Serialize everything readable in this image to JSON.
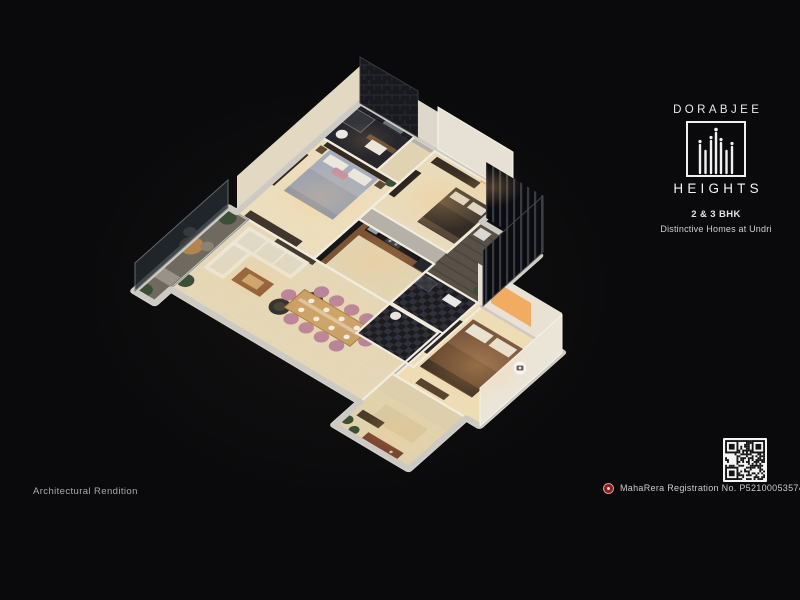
{
  "page": {
    "background": "#0a0a0c",
    "width": 800,
    "height": 600
  },
  "brand": {
    "name_line1": "DORABJEE",
    "name_line2": "HEIGHTS",
    "offering": "2 & 3 BHK",
    "tagline": "Distinctive Homes at Undri"
  },
  "footer": {
    "rendition_note": "Architectural Rendition",
    "rera_label": "MahaRera Registration No. P52100053574"
  },
  "floorplan": {
    "type": "3d-isometric-apartment-render",
    "rooms": [
      "bathroom-1",
      "master-bedroom",
      "bedroom-2",
      "kitchen",
      "living-room",
      "dining-area",
      "balcony-left",
      "balcony-right",
      "bathroom-2",
      "bedroom-3",
      "foyer-entrance"
    ]
  },
  "colors": {
    "background": "#0a0a0c",
    "floor_beige": "#e5d7b6",
    "wall_white": "#f2ecdf",
    "wall_gray": "#d8d5ce",
    "accent_dark_tile": "#1b1b20",
    "wood": "#7c5434",
    "sofa_cream": "#ece6d6",
    "bed_gray": "#a6aebc",
    "bed_brown": "#7a563d",
    "chair_pink": "#b9839a",
    "plant_green": "#3b4f36",
    "warm_glow": "#ffc37a",
    "text_light": "#d6d6d6",
    "rera_maroon": "#8c1d23"
  }
}
